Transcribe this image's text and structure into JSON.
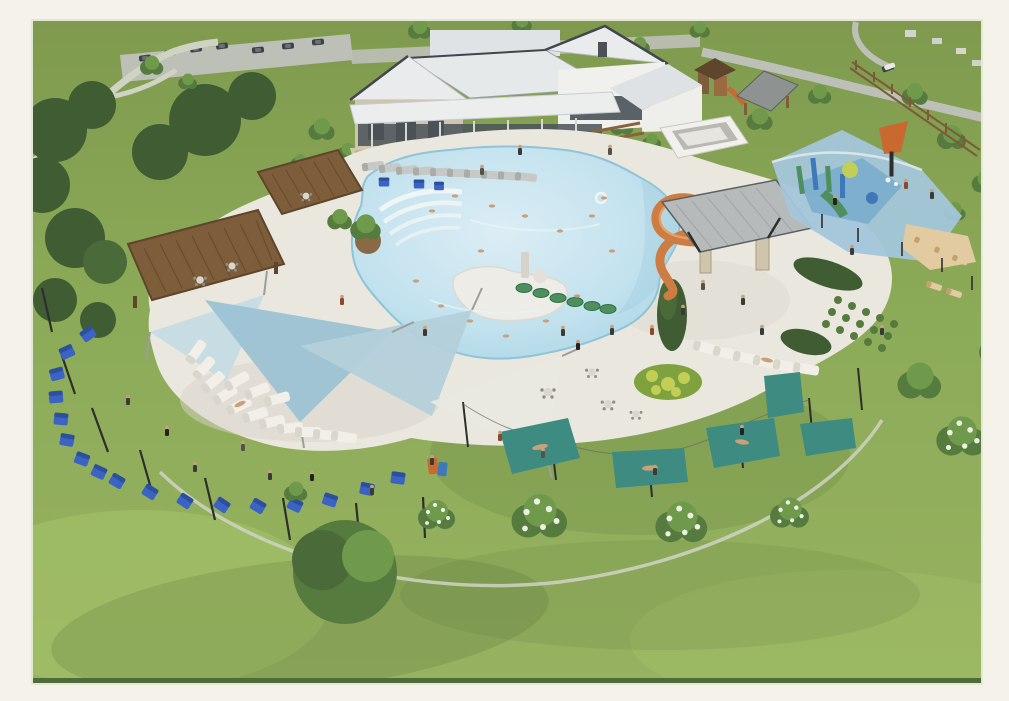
{
  "meta": {
    "kind": "3d-architectural-rendering",
    "subject": "aerial rendering of a community amenity center: freeform resort pool with clubhouse, pergolas, shade sails, lounge seating, spiral water slide, splash pad, hammock grove and lawns",
    "visible_text": ""
  },
  "frame": {
    "photo_left": 33,
    "photo_top": 21,
    "photo_width": 948,
    "photo_height": 662
  },
  "palette": {
    "margin": "#f4f2e9",
    "photoBottomEdge": "#4f6b39",
    "grass": "#8cab58",
    "grassLight": "#a6c26a",
    "grassDark": "#6d8c44",
    "deck": "#eae7df",
    "deckShadow": "#d8d4ca",
    "water": "#bfe1ec",
    "waterDeep": "#a3cfe0",
    "waterLight": "#dcEFf6",
    "roofWhite": "#e9ebec",
    "roofGray": "#b4b8b9",
    "roofEdge": "#41464c",
    "stone": "#cfc5ae",
    "wood": "#7d5d3a",
    "woodDark": "#5e452b",
    "sailPale": "#c6dbe3",
    "sailBlue": "#9dc2d4",
    "sailMid": "#b3d0da",
    "sailWhite": "#e9e8e0",
    "chairBlue": "#3a63c4",
    "lounger": "#f1efe8",
    "loungerGray": "#c6c9c6",
    "hammockTeal": "#3d8b81",
    "slideOrange": "#cd7c42",
    "slideHi": "#e8a268",
    "splashBlue": "#a3c6da",
    "splashDeep": "#78abcb",
    "sand": "#e2cba0",
    "playGreen": "#4f8f5f",
    "playBlue": "#3f78b8",
    "bucketOrange": "#c9682f",
    "treeDark": "#3f5c33",
    "treeMed": "#567b3e",
    "treeLight": "#6f9a4c",
    "blossom": "#edf1e4",
    "road": "#bcc0b7",
    "path": "#cfd3c4",
    "gravel": "#d8cfb6",
    "flowerYellow": "#c2ce55",
    "flowerGreen": "#7fa23f",
    "skin": "#c9a179",
    "pole": "#2e2e2a",
    "glass": "#4a5258"
  },
  "scene": {
    "elements": [
      "clubhouse",
      "parking-lot",
      "top-right-roads",
      "playground",
      "park-pavilion",
      "wood-rail-fence",
      "pool-deck",
      "freeform-pool",
      "beach-entry-steps",
      "island-planter",
      "lily-pad-walk",
      "pergola-large",
      "pergola-small",
      "shade-sail-cluster",
      "crescent-lounge-chairs",
      "poolside-loungers",
      "kids-chairs",
      "adirondack-chair-arc",
      "string-light-poles",
      "water-slide-tower",
      "restroom-building",
      "splash-pad",
      "tipping-bucket",
      "sand-lounge-area",
      "hedge-and-garden-rows",
      "flower-bed",
      "picnic-tables",
      "hammock-grove",
      "blossom-trees",
      "lawn",
      "walking-paths",
      "people",
      "swimmers"
    ],
    "counts": {
      "adirondack_chairs": 17,
      "crescent_loungers": 14,
      "poolside_loungers_top": 10,
      "poolside_loungers_right": 6,
      "hammocks": 5,
      "shade_sails": 4,
      "pergolas": 2
    },
    "lily_pads": 6
  }
}
